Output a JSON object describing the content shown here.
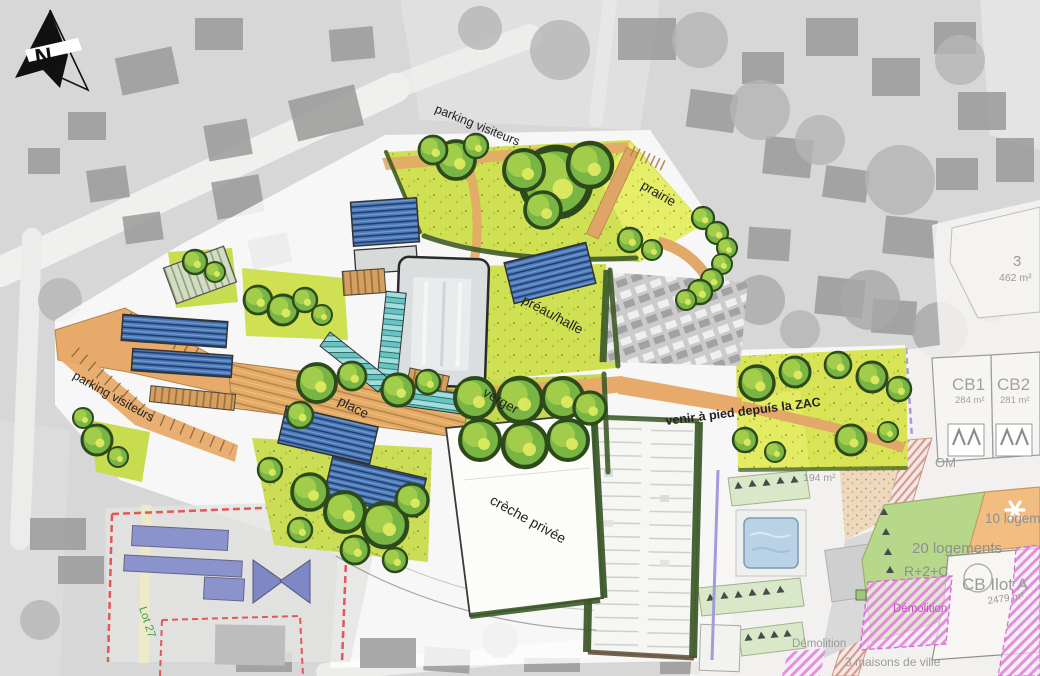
{
  "plan": {
    "north_label": "N",
    "labels": {
      "parking_visiteurs_top": "parking visiteurs",
      "prairie": "prairie",
      "preau_halle": "préau/halle",
      "place": "place",
      "verger": "verger",
      "venir_zac": "venir à pied depuis la ZAC",
      "creche_privee": "crèche privée",
      "parking_visiteurs_left": "parking visiteurs",
      "lot_27": "Lot 27"
    },
    "cadastre": {
      "parcel_3": {
        "number": "3",
        "area": "462 m²"
      },
      "cb1": {
        "name": "CB1",
        "area": "284 m²"
      },
      "cb2": {
        "name": "CB2",
        "area": "281 m²"
      },
      "om": "OM",
      "area_194": "194 m²",
      "logements_10": "10 logements",
      "logements_20": "20 logements",
      "hauteur": "R+2+C",
      "cb_ilot": {
        "name": "CB Ilot A",
        "area": "2479 m²"
      },
      "demolition_1": "Démolition",
      "demolition_2": "Démolition",
      "maisons_de_ville": "3 maisons de ville"
    },
    "colors": {
      "lawn": "#cfe052",
      "prairie": "#e9f06a",
      "path": "#e8aa6a",
      "solar_roof": "#4d7ab8",
      "canopy": "#9fdedd",
      "hedge": "#3e5b28",
      "demolition_pink": "#df7fd8",
      "boundary_red": "#e05858",
      "existing_building_blue": "#8a93cb",
      "parcel_green": "#b7d88b",
      "parcel_orange": "#f2bd80",
      "cadastre_text": "#9a9a9a",
      "lot_text_green": "#3f9e4f"
    }
  }
}
